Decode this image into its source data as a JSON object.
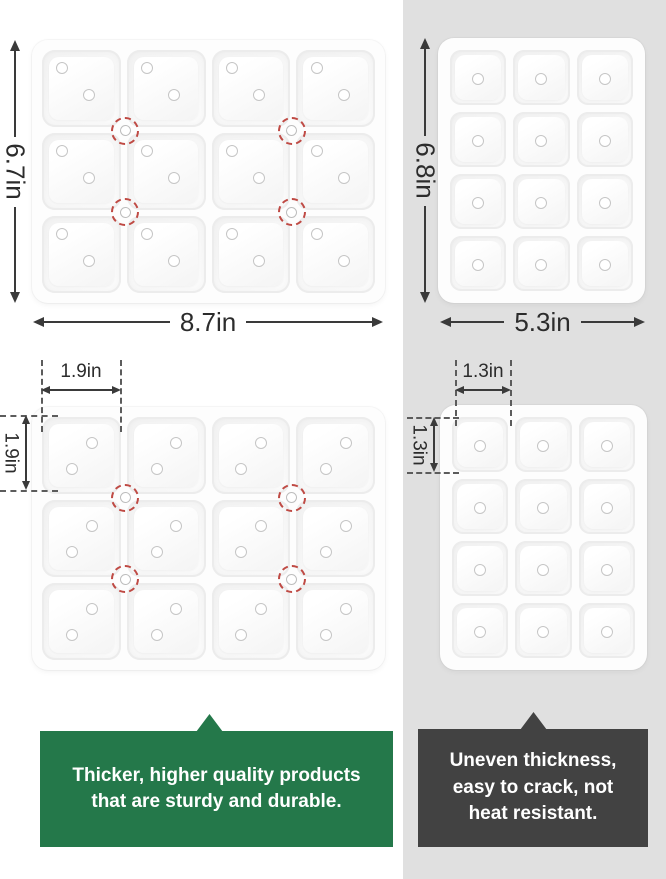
{
  "colors": {
    "panel_bg": "#e0e0e0",
    "good_callout": "#24784a",
    "bad_callout": "#424242",
    "callout_text": "#ffffff",
    "dim": "#3a3a3a",
    "marker": "#bf4a44"
  },
  "good_product": {
    "overall_width": "8.7in",
    "overall_height": "6.7in",
    "cell_width": "1.9in",
    "cell_height": "1.9in",
    "tray_top": {
      "cols": 4,
      "rows": 3,
      "hole_positions": [
        [
          26,
          23
        ],
        [
          60,
          58
        ]
      ],
      "markers": true
    },
    "tray_bottom": {
      "cols": 4,
      "rows": 3,
      "hole_positions": [
        [
          63,
          34
        ],
        [
          38,
          67
        ]
      ],
      "markers": true
    },
    "callout": {
      "lines": [
        "Thicker, higher quality products",
        "that are sturdy and durable."
      ]
    }
  },
  "bad_product": {
    "overall_width": "5.3in",
    "overall_height": "6.8in",
    "cell_width": "1.3in",
    "cell_height": "1.3in",
    "tray_top": {
      "cols": 3,
      "rows": 4,
      "hole_positions": [
        [
          50,
          52
        ]
      ],
      "markers": false
    },
    "tray_bottom": {
      "cols": 3,
      "rows": 4,
      "hole_positions": [
        [
          50,
          52
        ]
      ],
      "markers": false
    },
    "callout": {
      "lines": [
        "Uneven thickness,",
        "easy to crack, not",
        "heat resistant."
      ]
    }
  }
}
